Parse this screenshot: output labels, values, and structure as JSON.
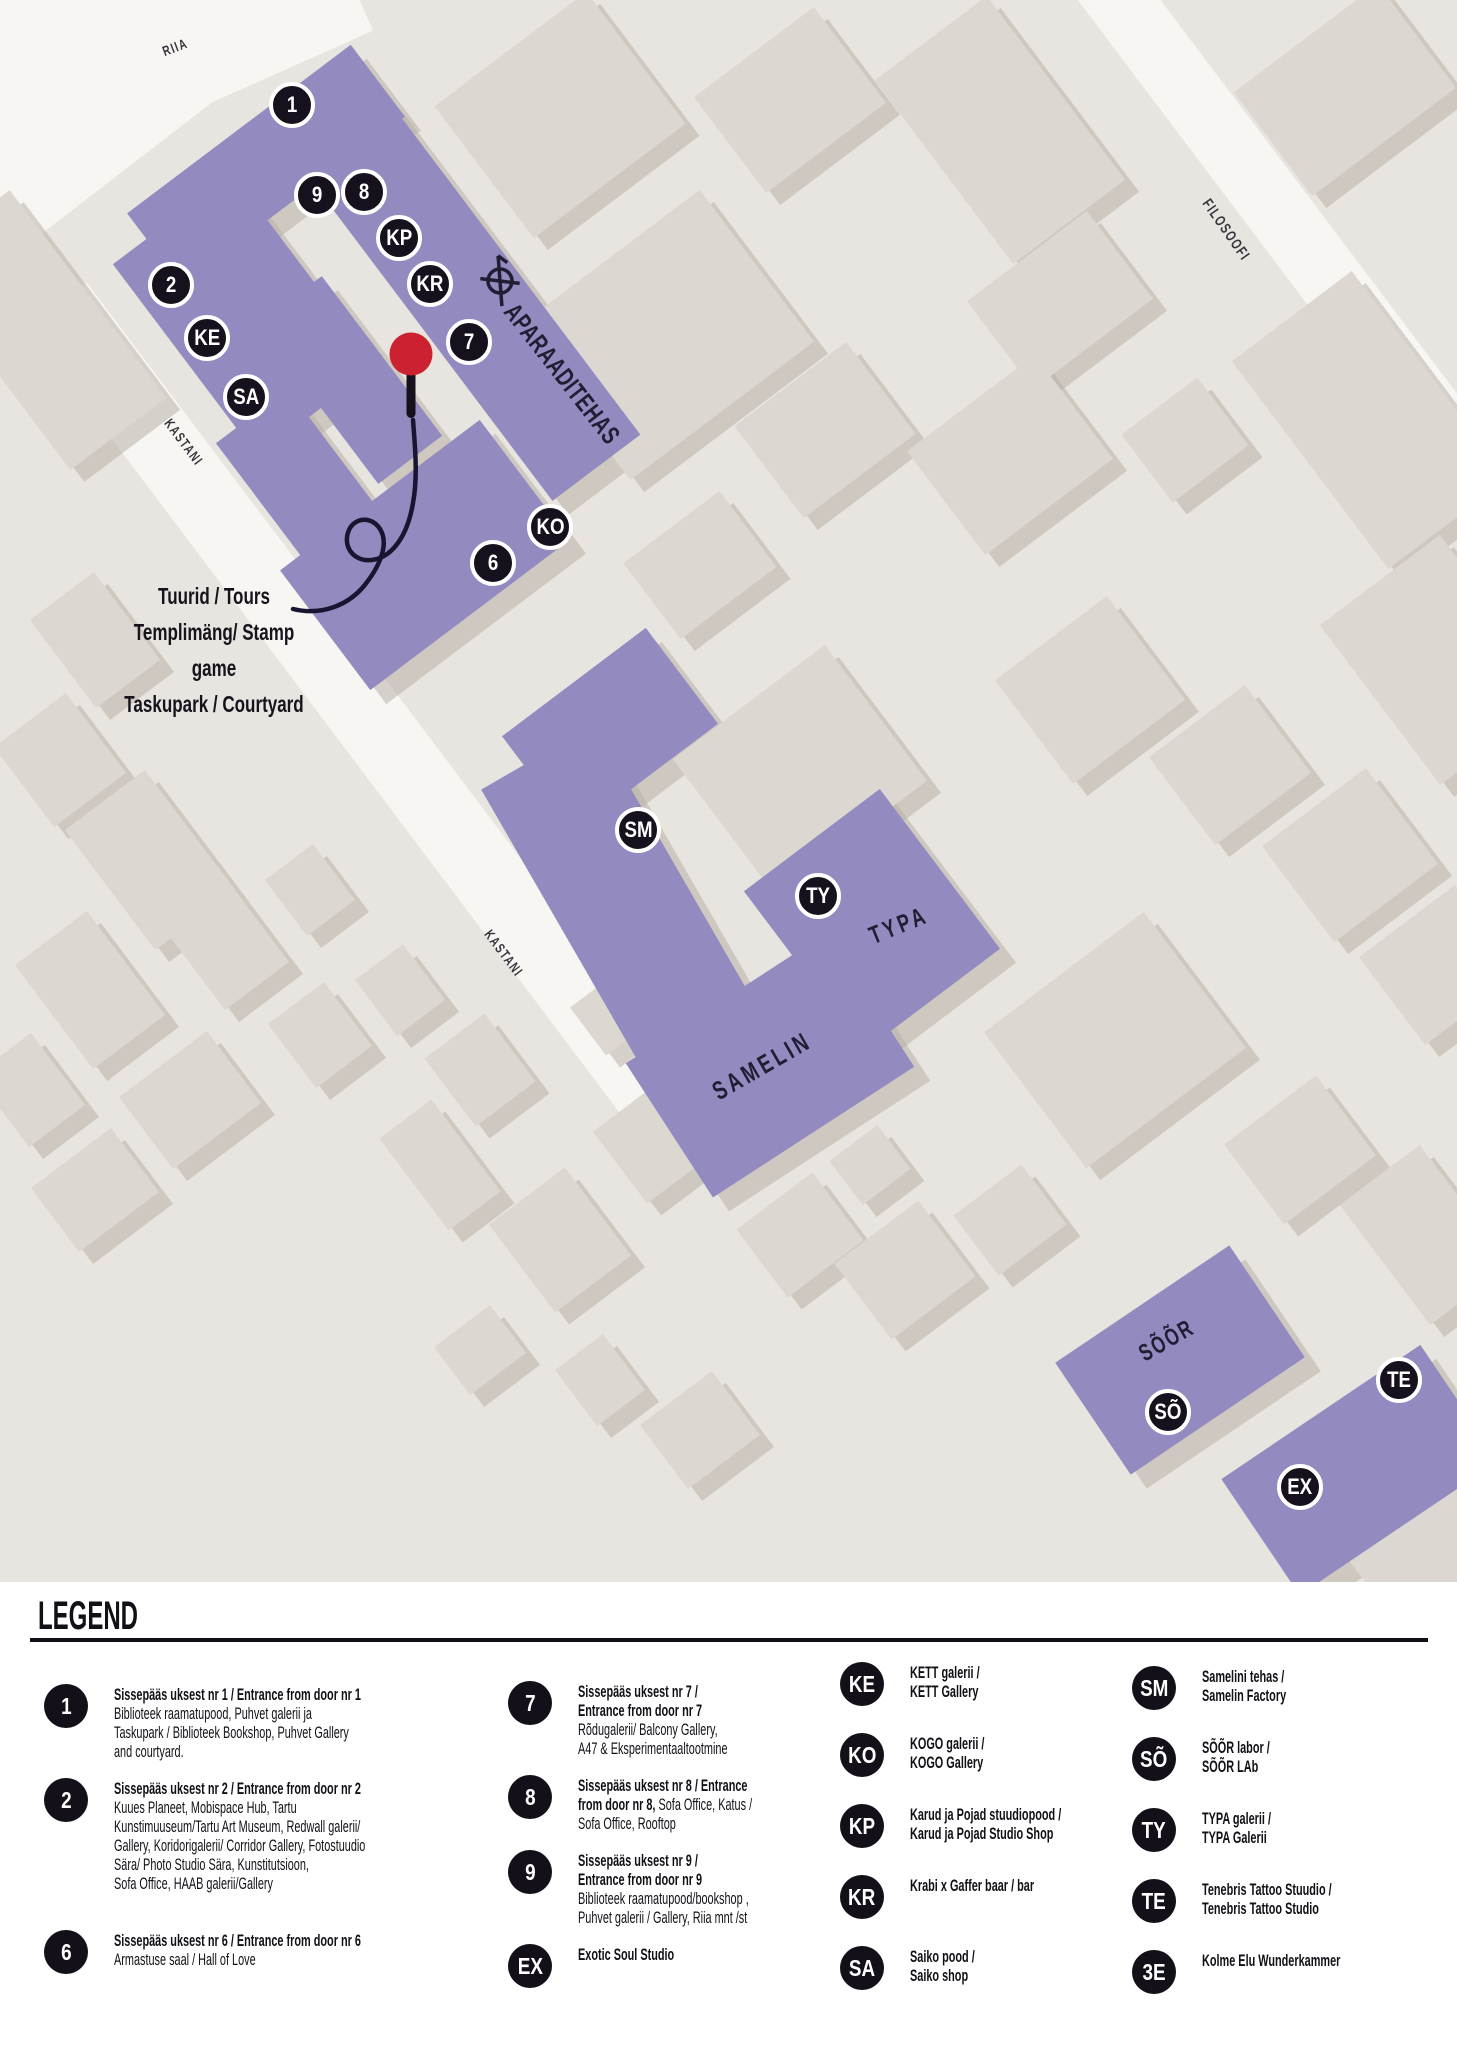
{
  "map": {
    "colors": {
      "background": "#e8e4df",
      "road": "#f7f6f3",
      "building": "#dcd7d0",
      "building_shadow": "#b9b1a6",
      "purple": "#938ac0",
      "marker_black": "#16111c",
      "pin_red": "#cb2130",
      "line_dark": "#191430"
    },
    "streets": [
      {
        "name": "RIIA",
        "x": 175,
        "y": 47,
        "rot": -21,
        "size": 14,
        "ls": 2
      },
      {
        "name": "KASTANI",
        "x": 184,
        "y": 442,
        "rot": 53,
        "size": 14,
        "ls": 2
      },
      {
        "name": "KASTANI",
        "x": 504,
        "y": 953,
        "rot": 53,
        "size": 14,
        "ls": 2
      },
      {
        "name": "FILOSOOFI",
        "x": 1226,
        "y": 230,
        "rot": 55,
        "size": 15,
        "ls": 2
      }
    ],
    "building_labels": [
      {
        "text": "APARAADITEHAS",
        "x": 562,
        "y": 374,
        "rot": 52,
        "size": 26,
        "ls": 1
      },
      {
        "text": "TYPA",
        "x": 899,
        "y": 926,
        "rot": -22,
        "size": 25,
        "ls": 5
      },
      {
        "text": "SAMELIN",
        "x": 762,
        "y": 1066,
        "rot": -30,
        "size": 26,
        "ls": 5
      },
      {
        "text": "SÕÕR",
        "x": 1167,
        "y": 1341,
        "rot": -30,
        "size": 24,
        "ls": 3
      }
    ],
    "markers": [
      {
        "label": "1",
        "x": 292,
        "y": 105
      },
      {
        "label": "9",
        "x": 317,
        "y": 195
      },
      {
        "label": "8",
        "x": 364,
        "y": 192
      },
      {
        "label": "KP",
        "x": 399,
        "y": 238
      },
      {
        "label": "KR",
        "x": 430,
        "y": 284
      },
      {
        "label": "2",
        "x": 171,
        "y": 285
      },
      {
        "label": "KE",
        "x": 207,
        "y": 338
      },
      {
        "label": "SA",
        "x": 246,
        "y": 397
      },
      {
        "label": "7",
        "x": 469,
        "y": 342
      },
      {
        "label": "KO",
        "x": 550,
        "y": 527
      },
      {
        "label": "6",
        "x": 493,
        "y": 563
      },
      {
        "label": "SM",
        "x": 638,
        "y": 830
      },
      {
        "label": "TY",
        "x": 818,
        "y": 896
      },
      {
        "label": "SÕ",
        "x": 1168,
        "y": 1412
      },
      {
        "label": "TE",
        "x": 1399,
        "y": 1380
      },
      {
        "label": "EX",
        "x": 1300,
        "y": 1487
      }
    ],
    "pin": {
      "x": 411,
      "y": 354,
      "lines": [
        "Tuurid / Tours",
        "Templimäng/ Stamp game",
        "Taskupark / Courtyard"
      ]
    }
  },
  "legend": {
    "title": "LEGEND",
    "columns": [
      [
        {
          "id": "1",
          "lines": [
            {
              "parts": [
                {
                  "bold": true,
                  "text": "Sissepääs uksest nr 1 / Entrance from door nr 1"
                }
              ]
            },
            {
              "parts": [
                {
                  "bold": false,
                  "text": "Biblioteek raamatupood, Puhvet galerii ja"
                }
              ]
            },
            {
              "parts": [
                {
                  "bold": false,
                  "text": "Taskupark / Biblioteek Bookshop, Puhvet Gallery"
                }
              ]
            },
            {
              "parts": [
                {
                  "bold": false,
                  "text": "and courtyard."
                }
              ]
            }
          ]
        },
        {
          "id": "2",
          "lines": [
            {
              "parts": [
                {
                  "bold": true,
                  "text": "Sissepääs uksest nr 2 / Entrance from door nr 2"
                }
              ]
            },
            {
              "parts": [
                {
                  "bold": false,
                  "text": "Kuues Planeet, Mobispace Hub, Tartu"
                }
              ]
            },
            {
              "parts": [
                {
                  "bold": false,
                  "text": "Kunstimuuseum/Tartu Art Museum, Redwall galerii/"
                }
              ]
            },
            {
              "parts": [
                {
                  "bold": false,
                  "text": "Gallery, Koridorigalerii/ Corridor Gallery, Fotostuudio"
                }
              ]
            },
            {
              "parts": [
                {
                  "bold": false,
                  "text": "Sära/ Photo Studio Sära, Kunstitutsioon,"
                }
              ]
            },
            {
              "parts": [
                {
                  "bold": false,
                  "text": "Sofa Office, HAAB galerii/Gallery"
                }
              ]
            }
          ]
        },
        {
          "id": "6",
          "lines": [
            {
              "parts": [
                {
                  "bold": true,
                  "text": "Sissepääs uksest nr 6 / Entrance from door nr 6"
                }
              ]
            },
            {
              "parts": [
                {
                  "bold": false,
                  "text": "Armastuse saal / Hall of Love"
                }
              ]
            }
          ]
        }
      ],
      [
        {
          "id": "7",
          "lines": [
            {
              "parts": [
                {
                  "bold": true,
                  "text": "Sissepääs uksest nr 7 /"
                }
              ]
            },
            {
              "parts": [
                {
                  "bold": true,
                  "text": "Entrance from door nr 7"
                }
              ]
            },
            {
              "parts": [
                {
                  "bold": false,
                  "text": "Rõdugalerii/ Balcony Gallery,"
                }
              ]
            },
            {
              "parts": [
                {
                  "bold": false,
                  "text": "A47 & Eksperimentaaltootmine"
                }
              ]
            }
          ]
        },
        {
          "id": "8",
          "lines": [
            {
              "parts": [
                {
                  "bold": true,
                  "text": "Sissepääs uksest nr 8 / Entrance"
                }
              ]
            },
            {
              "parts": [
                {
                  "bold": true,
                  "text": "from door nr 8,"
                },
                {
                  "bold": false,
                  "text": " Sofa Office, Katus /"
                }
              ]
            },
            {
              "parts": [
                {
                  "bold": false,
                  "text": "Sofa Office, Rooftop"
                }
              ]
            }
          ]
        },
        {
          "id": "9",
          "lines": [
            {
              "parts": [
                {
                  "bold": true,
                  "text": "Sissepääs uksest nr 9 /"
                }
              ]
            },
            {
              "parts": [
                {
                  "bold": true,
                  "text": "Entrance from door nr 9"
                }
              ]
            },
            {
              "parts": [
                {
                  "bold": false,
                  "text": "Biblioteek raamatupood/bookshop ,"
                }
              ]
            },
            {
              "parts": [
                {
                  "bold": false,
                  "text": "Puhvet galerii / Gallery, Riia mnt /st"
                }
              ]
            }
          ]
        },
        {
          "id": "EX",
          "lines": [
            {
              "parts": [
                {
                  "bold": true,
                  "text": "Exotic Soul Studio"
                }
              ]
            }
          ]
        }
      ],
      [
        {
          "id": "KE",
          "lines": [
            {
              "parts": [
                {
                  "bold": true,
                  "text": "KETT galerii /"
                }
              ]
            },
            {
              "parts": [
                {
                  "bold": true,
                  "text": "KETT Gallery"
                }
              ]
            }
          ]
        },
        {
          "id": "KO",
          "lines": [
            {
              "parts": [
                {
                  "bold": true,
                  "text": "KOGO galerii /"
                }
              ]
            },
            {
              "parts": [
                {
                  "bold": true,
                  "text": "KOGO Gallery"
                }
              ]
            }
          ]
        },
        {
          "id": "KP",
          "lines": [
            {
              "parts": [
                {
                  "bold": true,
                  "text": "Karud ja Pojad stuudiopood /"
                }
              ]
            },
            {
              "parts": [
                {
                  "bold": true,
                  "text": "Karud ja Pojad Studio Shop"
                }
              ]
            }
          ]
        },
        {
          "id": "KR",
          "lines": [
            {
              "parts": [
                {
                  "bold": true,
                  "text": "Krabi x Gaffer baar / bar"
                }
              ]
            }
          ]
        },
        {
          "id": "SA",
          "lines": [
            {
              "parts": [
                {
                  "bold": true,
                  "text": "Saiko pood /"
                }
              ]
            },
            {
              "parts": [
                {
                  "bold": true,
                  "text": "Saiko shop"
                }
              ]
            }
          ]
        }
      ],
      [
        {
          "id": "SM",
          "lines": [
            {
              "parts": [
                {
                  "bold": true,
                  "text": "Samelini tehas /"
                }
              ]
            },
            {
              "parts": [
                {
                  "bold": true,
                  "text": "Samelin Factory"
                }
              ]
            }
          ]
        },
        {
          "id": "SÕ",
          "lines": [
            {
              "parts": [
                {
                  "bold": true,
                  "text": "SÕÕR labor /"
                }
              ]
            },
            {
              "parts": [
                {
                  "bold": true,
                  "text": "SÕÕR LAb"
                }
              ]
            }
          ]
        },
        {
          "id": "TY",
          "lines": [
            {
              "parts": [
                {
                  "bold": true,
                  "text": "TYPA galerii /"
                }
              ]
            },
            {
              "parts": [
                {
                  "bold": true,
                  "text": "TYPA Galerii"
                }
              ]
            }
          ]
        },
        {
          "id": "TE",
          "lines": [
            {
              "parts": [
                {
                  "bold": true,
                  "text": "Tenebris Tattoo Stuudio /"
                }
              ]
            },
            {
              "parts": [
                {
                  "bold": true,
                  "text": "Tenebris Tattoo Studio"
                }
              ]
            }
          ]
        },
        {
          "id": "3E",
          "lines": [
            {
              "parts": [
                {
                  "bold": true,
                  "text": "Kolme Elu Wunderkammer"
                }
              ]
            }
          ]
        }
      ]
    ]
  }
}
